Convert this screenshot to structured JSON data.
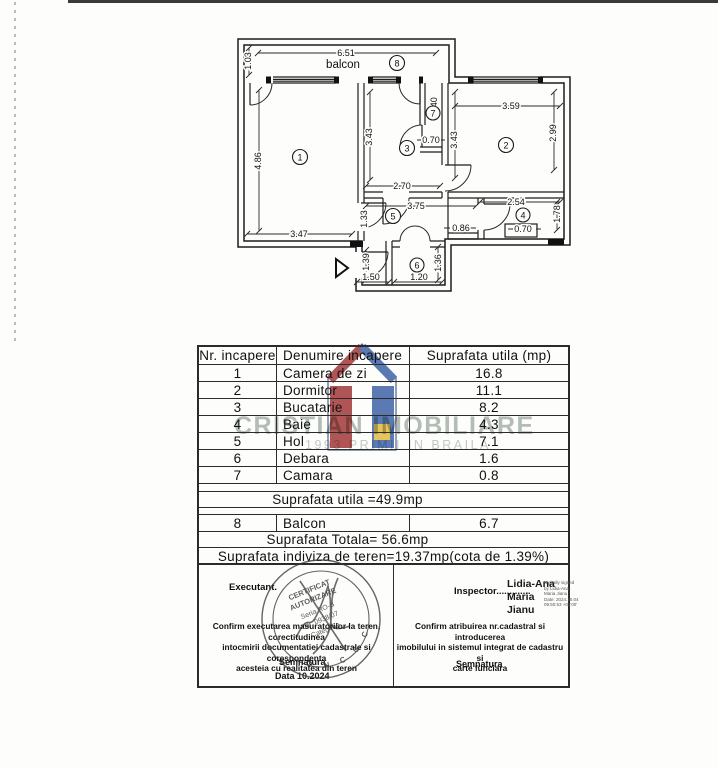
{
  "plan": {
    "balcony_label": "balcon",
    "room_numbers": [
      "1",
      "2",
      "3",
      "4",
      "5",
      "6",
      "7",
      "8"
    ],
    "dims": {
      "balcony_width": "6.51",
      "balcony_depth": "1.03",
      "r1_h": "4.86",
      "r1_w": "3.47",
      "r3_h": "3.43",
      "r3_w": "2.70",
      "r7_h": "1.40",
      "r7_w": "0.70",
      "r2_w": "3.59",
      "r2_h_left": "3.43",
      "r2_h_right": "2.99",
      "hol_w": "3.75",
      "hol_h": "1.33",
      "corridor_w": "0.86",
      "r4_w": "2.54",
      "r4_h": "1.78",
      "r4_door": "0.70",
      "r6_h": "1.36",
      "r6_w": "1.20",
      "entry_w": "1.50",
      "entry_h": "1.39"
    }
  },
  "table": {
    "headers": [
      "Nr. incapere",
      "Denumire incapere",
      "Suprafata utila (mp)"
    ],
    "rows": [
      {
        "nr": "1",
        "name": "Camera de zi",
        "area": "16.8"
      },
      {
        "nr": "2",
        "name": "Dormitor",
        "area": "11.1"
      },
      {
        "nr": "3",
        "name": "Bucatarie",
        "area": "8.2"
      },
      {
        "nr": "4",
        "name": "Baie",
        "area": "4.3"
      },
      {
        "nr": "5",
        "name": "Hol",
        "area": "7.1"
      },
      {
        "nr": "6",
        "name": "Debara",
        "area": "1.6"
      },
      {
        "nr": "7",
        "name": "Camara",
        "area": "0.8"
      }
    ],
    "subtotal": "Suprafata utila =49.9mp",
    "balcony_row": {
      "nr": "8",
      "name": "Balcon",
      "area": "6.7"
    },
    "total": "Suprafata Totala= 56.6mp",
    "land_share": "Suprafata indiviza de teren=19.37mp(cota de 1.39%)"
  },
  "certification": {
    "executant": {
      "label": "Executant.",
      "statement_l1": "Confirm executarea masuratorilor la teren, corectitudinea",
      "statement_l2": "intocmirii documentatiei cadastrale si corespondenta",
      "statement_l3": "acesteia cu realitatea din teren",
      "signature_label": "Semnatura",
      "date_label": "Data 10.2024",
      "stamp": {
        "l1": "CERTIFICAT",
        "l2": "AUTORIZARE",
        "l3": "Seria RO-B",
        "l4": "Nr. 0938/07",
        "l5": "Categoria",
        "ring": "O N C G C"
      }
    },
    "inspector": {
      "label": "Inspector.............",
      "signer_l1": "Lidia-Ana",
      "signer_l2": "Maria",
      "signer_l3": "Jianu",
      "digital_l1": "Digitally signed",
      "digital_l2": "by Lidia-Ana-",
      "digital_l3": "Maria Jianu",
      "digital_l4": "Date: 2024.10.04",
      "digital_l5": "09:50:53 +03'00'",
      "statement_l1": "Confirm atribuirea nr.cadastral si introducerea",
      "statement_l2": "imobilului in sistemul integrat de cadastru si",
      "statement_l3": "carte funciara",
      "signature_label": "Semnatura"
    }
  },
  "watermark": {
    "brand": "CRISTIAN IMOBILIARE",
    "tagline": "1993 PRIMII IN BRAILA"
  }
}
